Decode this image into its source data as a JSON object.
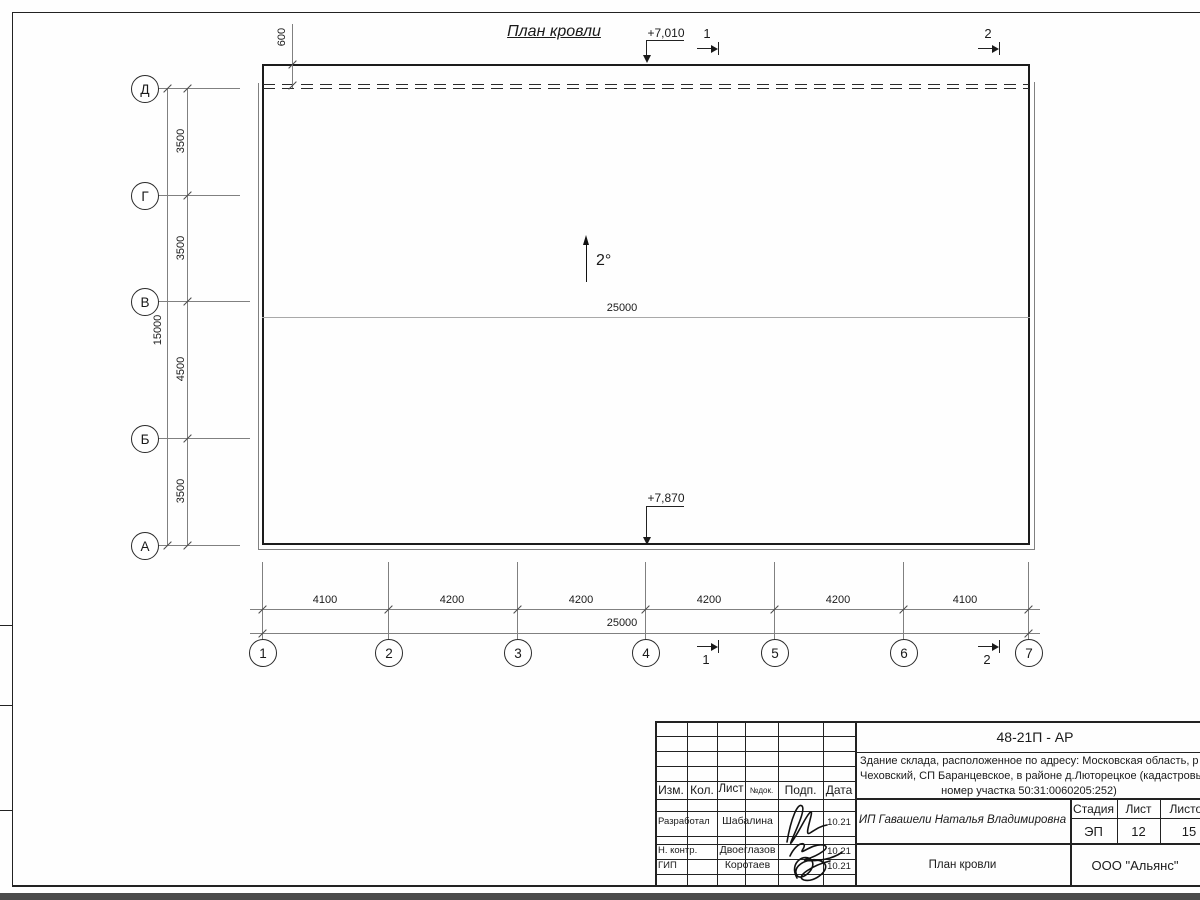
{
  "drawing": {
    "title": "План кровли",
    "slope": "2°",
    "elevation_top": "+7,010",
    "elevation_bottom": "+7,870",
    "offset_dim": "600",
    "roof_width_label": "25000",
    "section_marks": {
      "top1": "1",
      "top2": "2",
      "bottom1": "1",
      "bottom2": "2"
    },
    "axes_left": [
      "Д",
      "Г",
      "В",
      "Б",
      "А"
    ],
    "left_dims": [
      "3500",
      "3500",
      "4500",
      "3500"
    ],
    "left_total": "15000",
    "axes_bottom": [
      "1",
      "2",
      "3",
      "4",
      "5",
      "6",
      "7"
    ],
    "bottom_dims": [
      "4100",
      "4200",
      "4200",
      "4200",
      "4200",
      "4100"
    ],
    "bottom_total": "25000"
  },
  "title_block": {
    "doc_code": "48-21П - АР",
    "description": [
      "Здание склада, расположенное по адресу: Московская область, р",
      "Чеховский, СП Баранцевское, в районе д.Люторецкое  (кадастровы",
      "номер участка 50:31:0060205:252)"
    ],
    "columns": [
      "Изм.",
      "Кол.",
      "Лист",
      "№док.",
      "Подп.",
      "Дата"
    ],
    "signers": [
      {
        "role": "Разработал",
        "name": "Шабалина",
        "date": "10.21"
      },
      {
        "role": "Н. контр.",
        "name": "Двоеглазов",
        "date": "10.21"
      },
      {
        "role": "ГИП",
        "name": "Коротаев",
        "date": "10.21"
      }
    ],
    "client": "ИП Гавашели Наталья Владимировна",
    "stage_label": "Стадия",
    "sheet_label": "Лист",
    "sheets_label": "Листов",
    "stage": "ЭП",
    "sheet": "12",
    "sheets": "15",
    "sheet_title": "План кровли",
    "company": "ООО \"Альянс\""
  }
}
